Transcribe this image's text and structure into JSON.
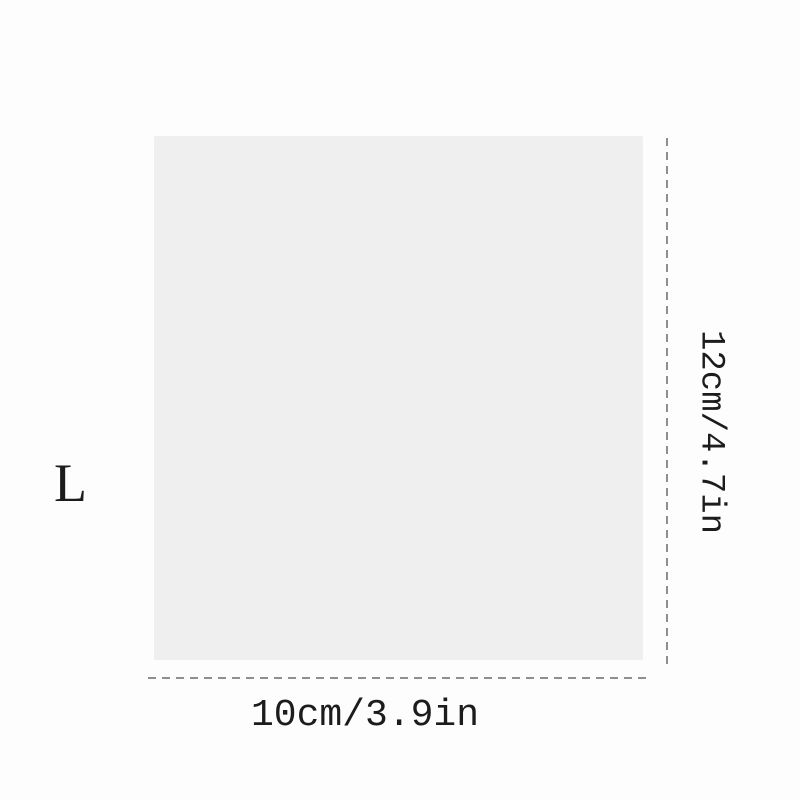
{
  "diagram": {
    "type": "product-dimension-diagram",
    "size_label": "L",
    "width_label": "10cm/3.9in",
    "height_label": "12cm/4.7in"
  },
  "colors": {
    "background": "#fdfdfd",
    "swatch_fill": "#efefef",
    "dashed_line": "#8f8f8f",
    "text": "#1c1c1c"
  }
}
